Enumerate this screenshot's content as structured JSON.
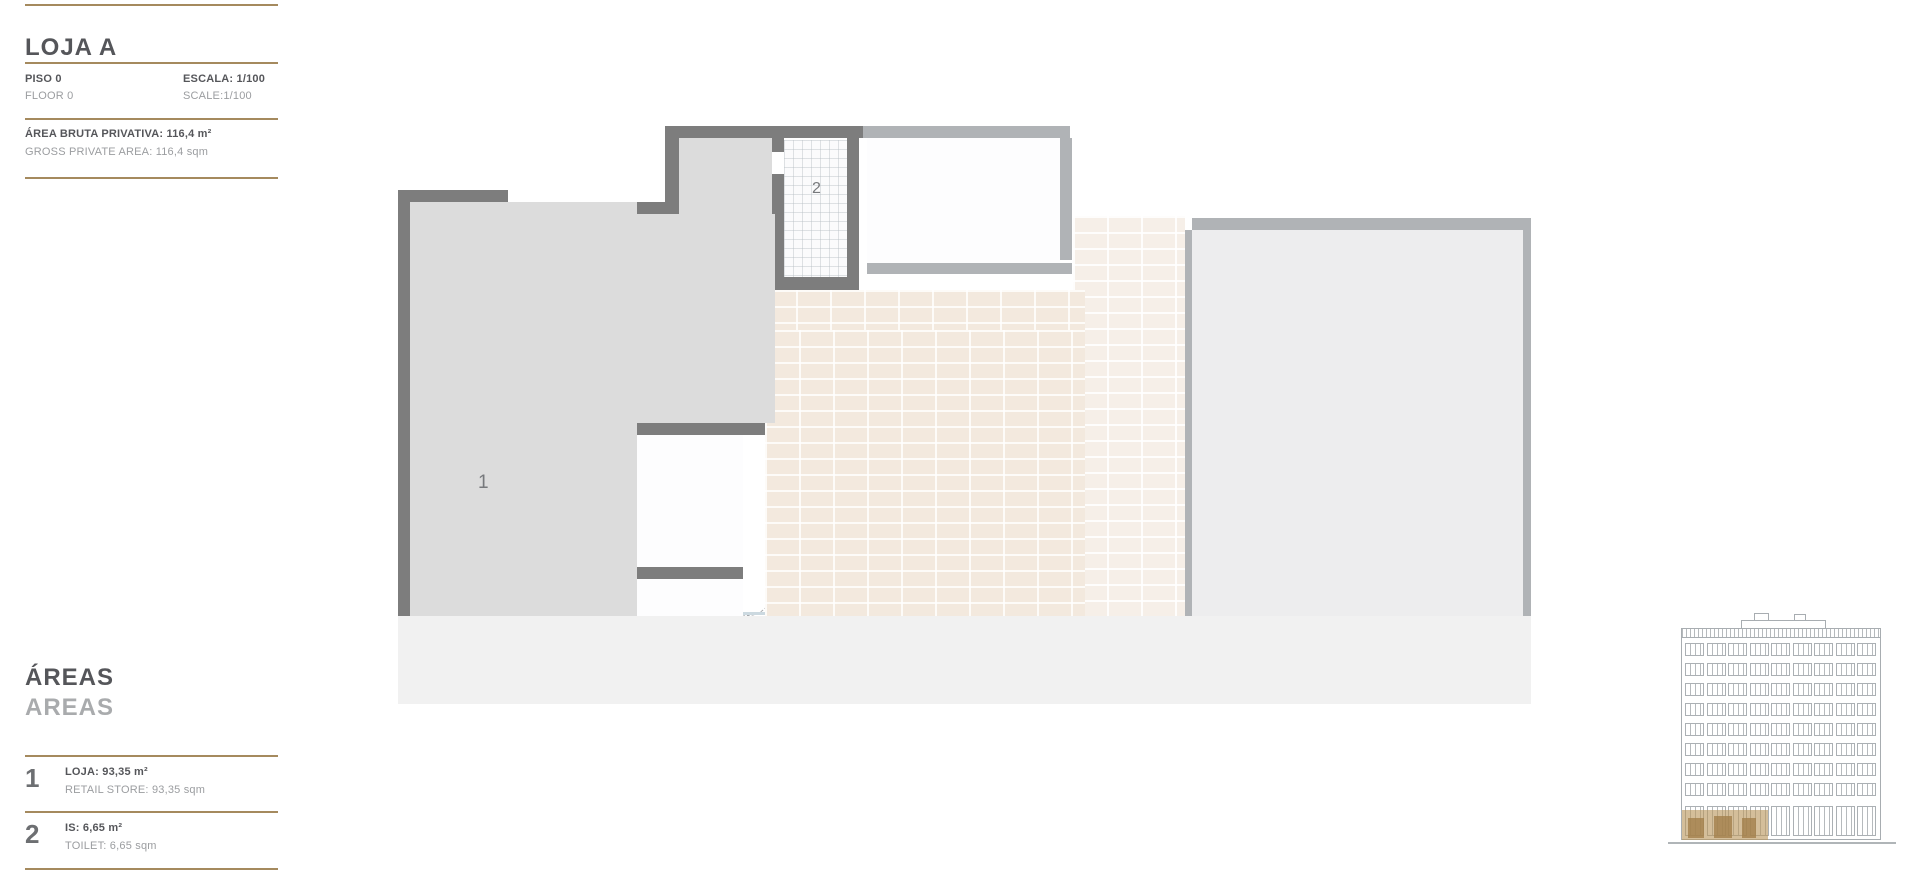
{
  "header": {
    "title": "LOJA A",
    "floor_pt": "PISO 0",
    "floor_en": "FLOOR 0",
    "scale_pt": "ESCALA: 1/100",
    "scale_en": "SCALE:1/100",
    "gpa_pt": "ÁREA BRUTA PRIVATIVA: 116,4 m²",
    "gpa_en": "GROSS PRIVATE AREA: 116,4 sqm"
  },
  "legend": {
    "title_pt": "ÁREAS",
    "title_en": "AREAS",
    "items": [
      {
        "number": "1",
        "label_pt": "LOJA: 93,35 m²",
        "label_en": "RETAIL STORE: 93,35 sqm"
      },
      {
        "number": "2",
        "label_pt": "IS: 6,65 m²",
        "label_en": "TOILET: 6,65 sqm"
      }
    ]
  },
  "plan": {
    "labels": {
      "retail": "1",
      "toilet": "2"
    }
  },
  "theme": {
    "accent_gold": "#a58a5e",
    "title_dark": "#55565a",
    "text_gray": "#9b9da0",
    "wall_dark": "#7d7d7d",
    "wall_light": "#b0b3b6",
    "floor_gray": "#dcdcdc",
    "floor_other": "#ededee",
    "tile_beige": "#f3e9de",
    "sidewalk": "#f1f1f1",
    "entry_orange": "#e0633c",
    "elevation_highlight": "#ba965c"
  }
}
